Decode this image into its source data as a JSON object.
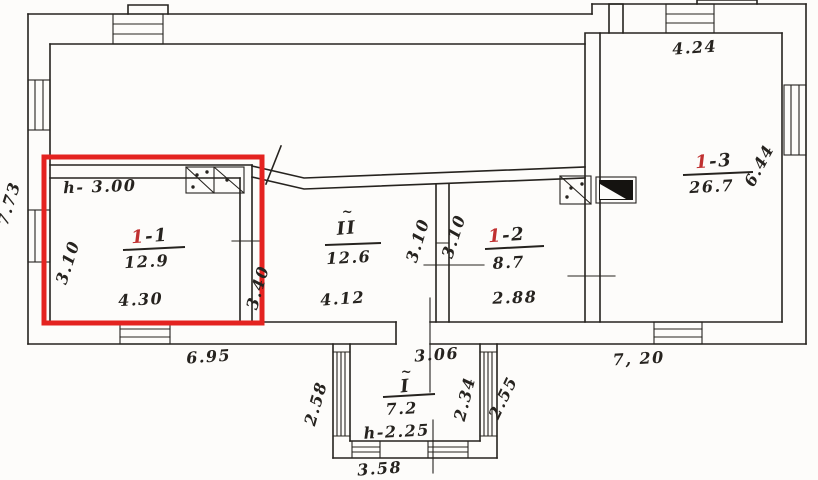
{
  "plan": {
    "rooms": {
      "r11": {
        "height_note": "h- 3.00",
        "number_red": "1",
        "number_rest": "-1",
        "area": "12.9",
        "width": "4.30",
        "depth_left": "3.10",
        "depth_right": "3.40"
      },
      "rII": {
        "tilde": "~",
        "number": "II",
        "area": "12.6",
        "width": "4.12",
        "wall_left_dim": "3.10",
        "wall_right_dim": "3.10"
      },
      "r12": {
        "number_red": "1",
        "number_rest": "-2",
        "area": "8.7",
        "width": "2.88"
      },
      "r13": {
        "number_red": "1",
        "number_rest": "-3",
        "area": "26.7",
        "width_top": "4.24",
        "depth_right": "6.44"
      },
      "annex": {
        "tilde": "~",
        "number": "I",
        "area": "7.2",
        "height_note": "h-2.25",
        "opening_width": "3.06",
        "bottom_width": "3.58",
        "side_left": "2.58",
        "side_right_inner": "2.34",
        "side_right_outer": "2.55"
      }
    },
    "exterior_dims": {
      "left_side": "7.73",
      "bottom_left": "6.95",
      "bottom_right": "7, 20"
    },
    "colors": {
      "highlight_red": "#e42320",
      "annotation_red": "#c03030",
      "ink": "#26231f",
      "paper": "#fdfcfa"
    }
  }
}
